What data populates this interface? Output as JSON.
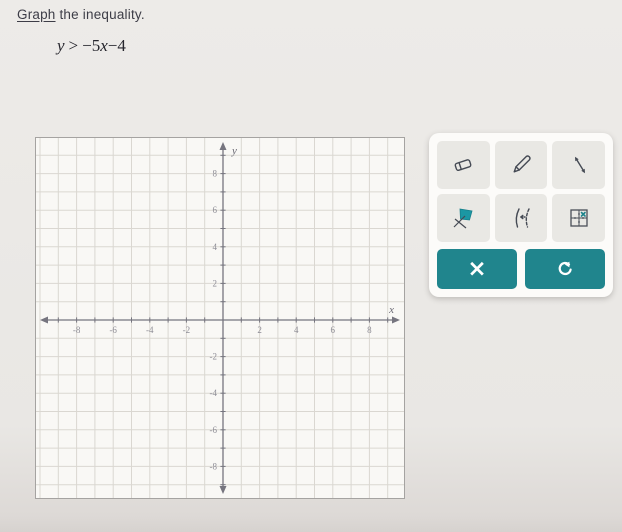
{
  "header": {
    "link_text": "Graph",
    "rest_text": " the inequality."
  },
  "equation": {
    "lhs": "y",
    "op": ">",
    "coef": "−5",
    "var": "x",
    "constant": "−4"
  },
  "graph": {
    "x_label": "x",
    "y_label": "y",
    "x_range": [
      -10,
      10
    ],
    "y_range": [
      -10,
      10
    ],
    "grid_step": 1,
    "x_tick_labels": [
      "-8",
      "-6",
      "-4",
      "-2",
      "2",
      "4",
      "6",
      "8"
    ],
    "y_tick_labels": [
      "-8",
      "-6",
      "-4",
      "-2",
      "2",
      "4",
      "6",
      "8"
    ]
  },
  "palette": {
    "tools": [
      {
        "name": "eraser"
      },
      {
        "name": "pencil"
      },
      {
        "name": "line-segment"
      },
      {
        "name": "half-plane-shade"
      },
      {
        "name": "dashed-boundary"
      },
      {
        "name": "plot-points-grid"
      }
    ],
    "actions": {
      "clear_symbol": "×",
      "clear_name": "clear",
      "undo_name": "undo"
    }
  },
  "colors": {
    "accent_teal": "#20858d",
    "tool_fill_teal": "#1b97a3",
    "grid_line": "#dad7d1",
    "axis": "#76757f"
  }
}
